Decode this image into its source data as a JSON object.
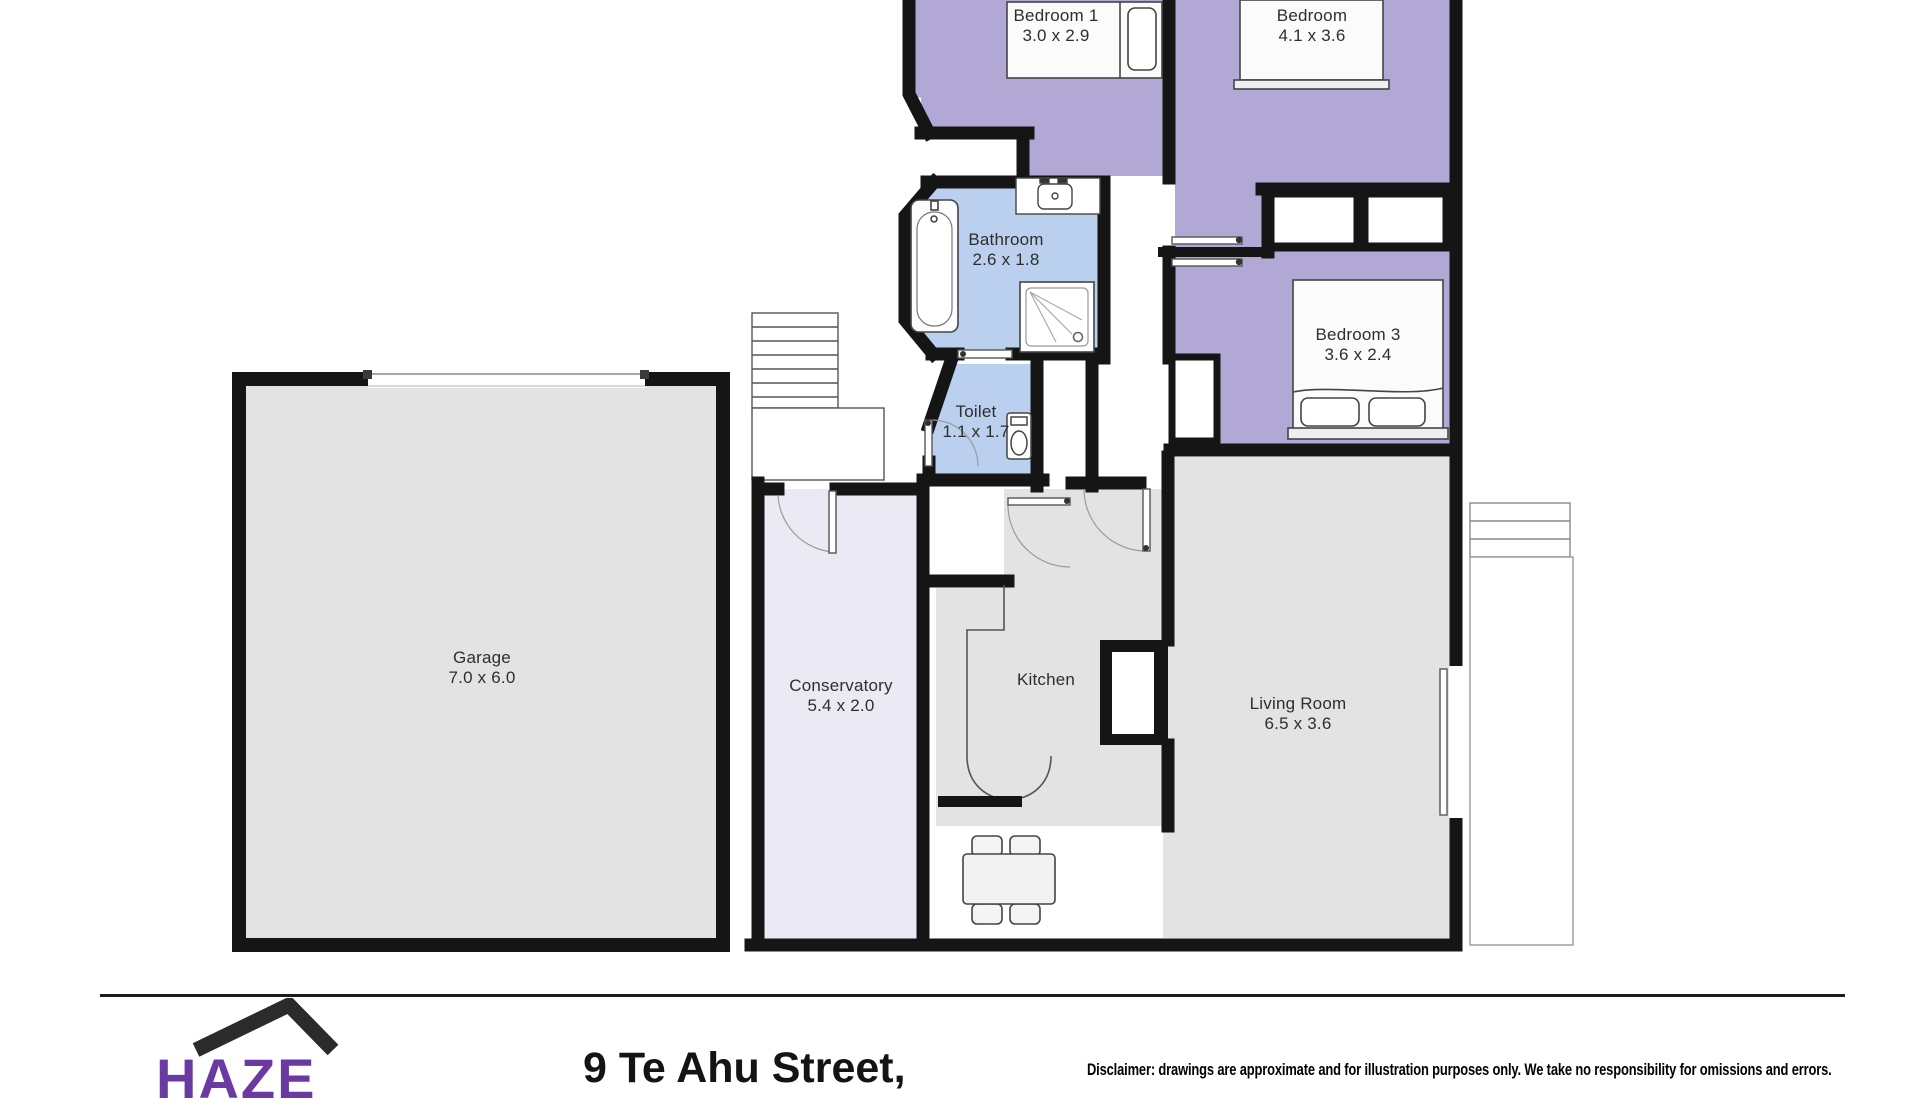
{
  "floorplan": {
    "rooms": [
      {
        "id": "bedroom1",
        "name": "Bedroom 1",
        "dims": "3.0 x 2.9"
      },
      {
        "id": "bedroom",
        "name": "Bedroom",
        "dims": "4.1 x 3.6"
      },
      {
        "id": "bedroom3",
        "name": "Bedroom 3",
        "dims": "3.6 x 2.4"
      },
      {
        "id": "bathroom",
        "name": "Bathroom",
        "dims": "2.6 x 1.8"
      },
      {
        "id": "toilet",
        "name": "Toilet",
        "dims": "1.1 x 1.7"
      },
      {
        "id": "garage",
        "name": "Garage",
        "dims": "7.0 x 6.0"
      },
      {
        "id": "conservatory",
        "name": "Conservatory",
        "dims": "5.4 x 2.0"
      },
      {
        "id": "kitchen",
        "name": "Kitchen",
        "dims": ""
      },
      {
        "id": "living",
        "name": "Living Room",
        "dims": "6.5 x 3.6"
      }
    ],
    "colors": {
      "bedroom_fill": "#b2a8d5",
      "bathroom_fill": "#badoee",
      "wet_room_fill": "#bad0ee",
      "gray_room_fill": "#e3e3e3",
      "conservatory_fill": "#ebeaf4",
      "wall": "#151515"
    },
    "fixtures": [
      "double-bed",
      "single-bed",
      "bathtub",
      "shower",
      "basin",
      "toilet",
      "wardrobes",
      "stairs",
      "dining-table",
      "fireplace",
      "kitchen-counter",
      "garage-door",
      "patio",
      "steps"
    ]
  },
  "footer": {
    "logo_text": "HAZE",
    "address": "9 Te Ahu Street,",
    "disclaimer": "Disclaimer: drawings are approximate and for illustration purposes only. We take no responsibility for omissions and errors."
  }
}
